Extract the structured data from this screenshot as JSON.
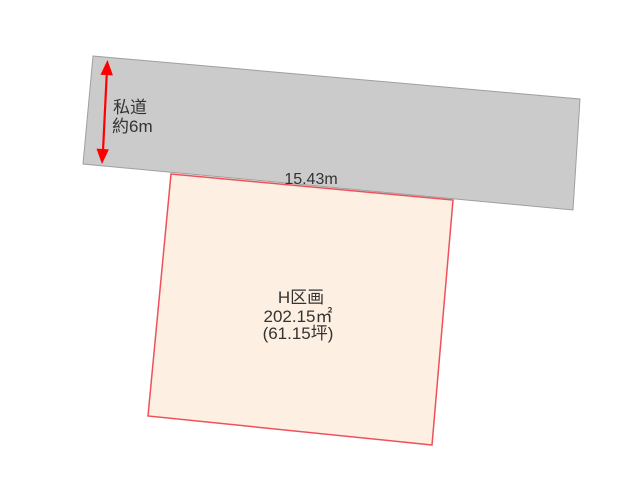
{
  "road": {
    "label": "私道",
    "width_label": "約6m"
  },
  "parcel": {
    "name": "H区画",
    "area_m2": "202.15㎡",
    "area_tsubo": "(61.15坪)",
    "frontage_label": "15.43m"
  },
  "colors": {
    "background": "#ffffff",
    "road_fill": "#cbcbcb",
    "road_stroke": "#9f9f9f",
    "parcel_fill": "#fdf0e2",
    "parcel_stroke": "#f0505a",
    "arrow": "#ff0000",
    "text": "#333333"
  }
}
